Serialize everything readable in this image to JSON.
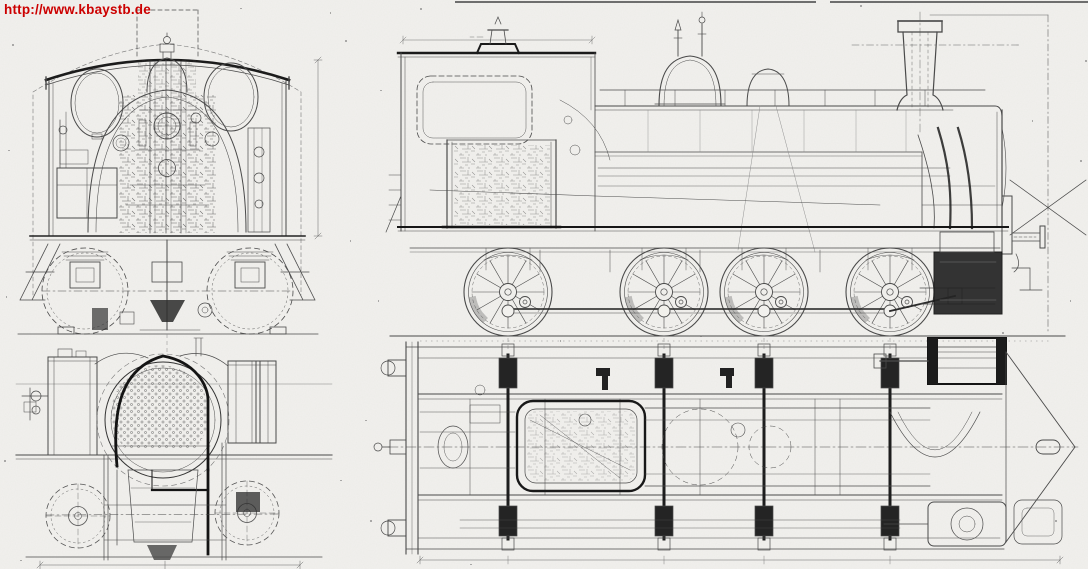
{
  "watermark": {
    "text": "http://www.kbaystb.de",
    "color": "#cc0000"
  },
  "scan": {
    "paper_color": "#f2f1ee",
    "ink_color": "#4a4a4a",
    "ink_dark_color": "#181818"
  }
}
